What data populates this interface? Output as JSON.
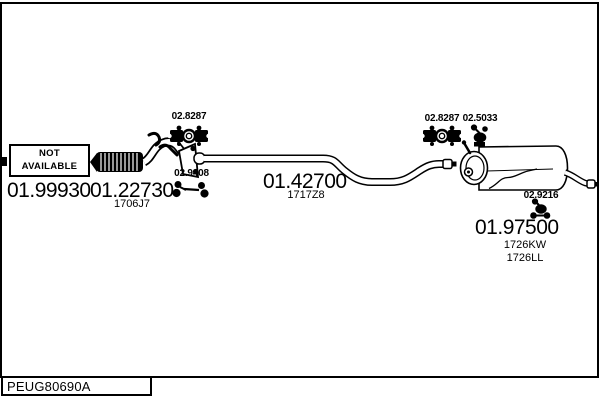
{
  "window": {
    "background": "#ffffff",
    "line_color": "#000000"
  },
  "footer": {
    "catalog_code": "PEUG80690A"
  },
  "diagram": {
    "not_available_box": {
      "line1": "NOT",
      "line2": "AVAILABLE"
    },
    "parts": [
      {
        "name": "front-pipe",
        "number": "01.99930"
      },
      {
        "name": "flex-pipe",
        "number": "01.22730",
        "variant": "1706J7"
      },
      {
        "name": "center-pipe",
        "number": "01.42700",
        "variant": "1717Z8"
      },
      {
        "name": "rear-silencer",
        "number": "01.97500",
        "variant": "1726KW",
        "variant2": "1726LL"
      }
    ],
    "fittings": [
      {
        "name": "clamp-front",
        "number": "02.8287"
      },
      {
        "name": "rubber-hanger-pair",
        "number": "02.9408"
      },
      {
        "name": "clamp-rear",
        "number": "02.8287"
      },
      {
        "name": "rubber-mount",
        "number": "02.5033"
      },
      {
        "name": "rear-hanger",
        "number": "02.9216"
      }
    ]
  }
}
